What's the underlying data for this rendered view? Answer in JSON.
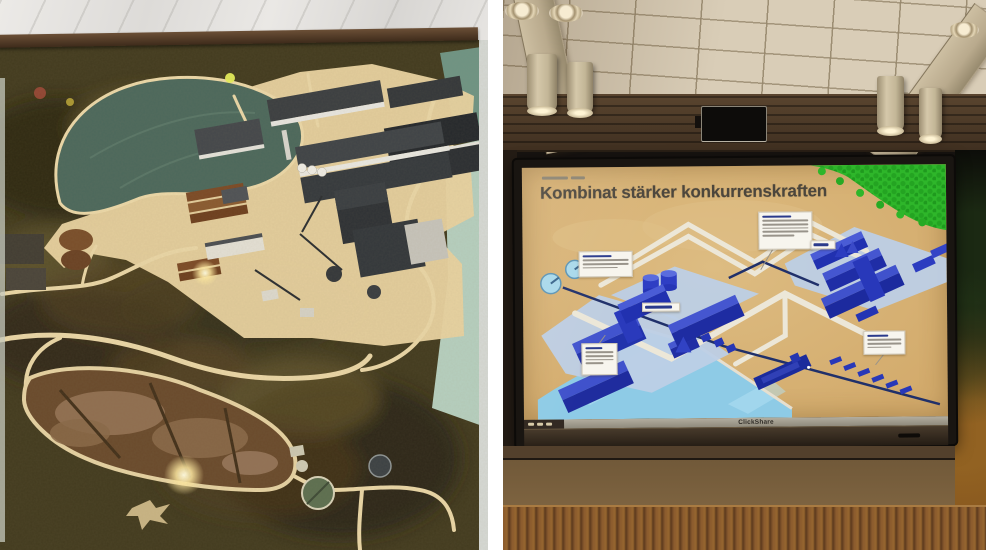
{
  "slide": {
    "title": "Kombinat stärker konkurrenskraften"
  },
  "screen": {
    "brand_label": "ClickShare"
  },
  "colors": {
    "slide_background": "#d8b277",
    "slide_title": "#4c463c",
    "building_blue": "#2636b4",
    "water_blue": "#8ecbe6",
    "pad_blue": "#bdcfe6",
    "forest_green": "#2eb62a",
    "pipe_cream": "#ece7d8",
    "model_terrain_dark": "#433b1f",
    "model_sand": "#e8d2a0",
    "model_lake": "#4c685c",
    "bezel_brown": "#2b241d",
    "wainscot_brown": "#8a5a2e"
  }
}
